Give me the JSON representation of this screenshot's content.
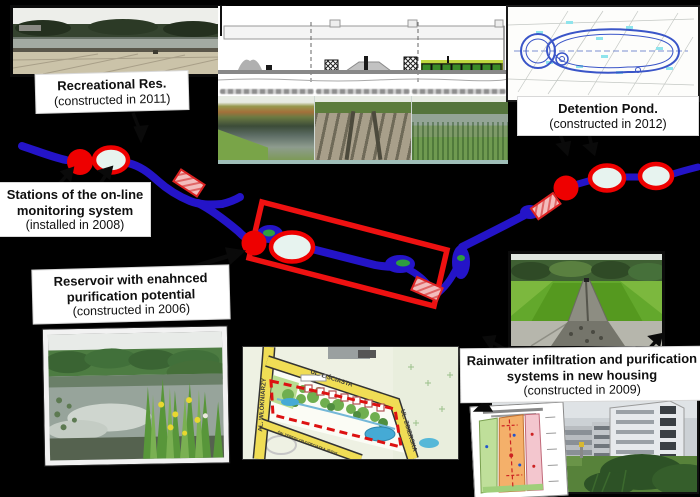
{
  "figure": {
    "background_color": "#000000",
    "river_color": "#2414c8",
    "marker_red": "#ee0000",
    "marker_light_fill": "#e7f3ef",
    "highlight_rect_color": "#ee1111"
  },
  "callouts": {
    "recreational": {
      "title": "Recreational Res.",
      "year": "(constructed in 2011)"
    },
    "detention": {
      "title": "Detention Pond.",
      "year": "(constructed in 2012)"
    },
    "stations": {
      "title_line1": "Stations of the on-line",
      "title_line2": "monitoring system",
      "year": "(installed in 2008)"
    },
    "reservoir": {
      "title_line1": "Reservoir with enahnced",
      "title_line2": "purification potential",
      "year": "(constructed in 2006)"
    },
    "rainwater": {
      "title_line1": "Rainwater infiltration and purification",
      "title_line2": "systems in new housing",
      "year": "(constructed in 2009)"
    }
  },
  "map": {
    "street_left": "AL. WŁÓKNIARZY",
    "street_top": "UL. LIŚCIASTA",
    "street_right": "UL. ZGIERSKA",
    "street_bottom": "ŚW. TERESY OD DZIECIĄTKA JEZUS"
  }
}
